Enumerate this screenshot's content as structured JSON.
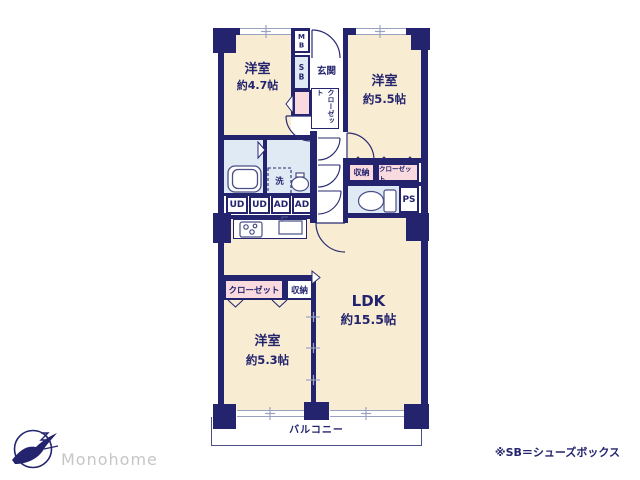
{
  "colors": {
    "navy": "#24246e",
    "cream": "#f8edd2",
    "light_blue": "#dfeaf4",
    "pink": "#f8dadf",
    "line_gray": "#9aa2c0",
    "brand_gray": "#c6c6c6"
  },
  "floorplan": {
    "rooms": {
      "bedroom_nw": {
        "name": "洋室",
        "size": "約4.7帖"
      },
      "bedroom_ne": {
        "name": "洋室",
        "size": "約5.5帖"
      },
      "bedroom_sw": {
        "name": "洋室",
        "size": "約5.3帖"
      },
      "ldk": {
        "name": "LDK",
        "size": "約15.5帖"
      },
      "entrance": "玄関",
      "balcony": "バルコニー"
    },
    "labels": {
      "meter_box": "MB",
      "shoe_box": "SB",
      "closet": "クローゼット",
      "storage": "収納",
      "laundry": "洗",
      "pipe_space": "PS",
      "ud": "UD",
      "ad": "AD"
    }
  },
  "footer": {
    "brand": "Monohome",
    "note": "※SB＝シューズボックス"
  }
}
